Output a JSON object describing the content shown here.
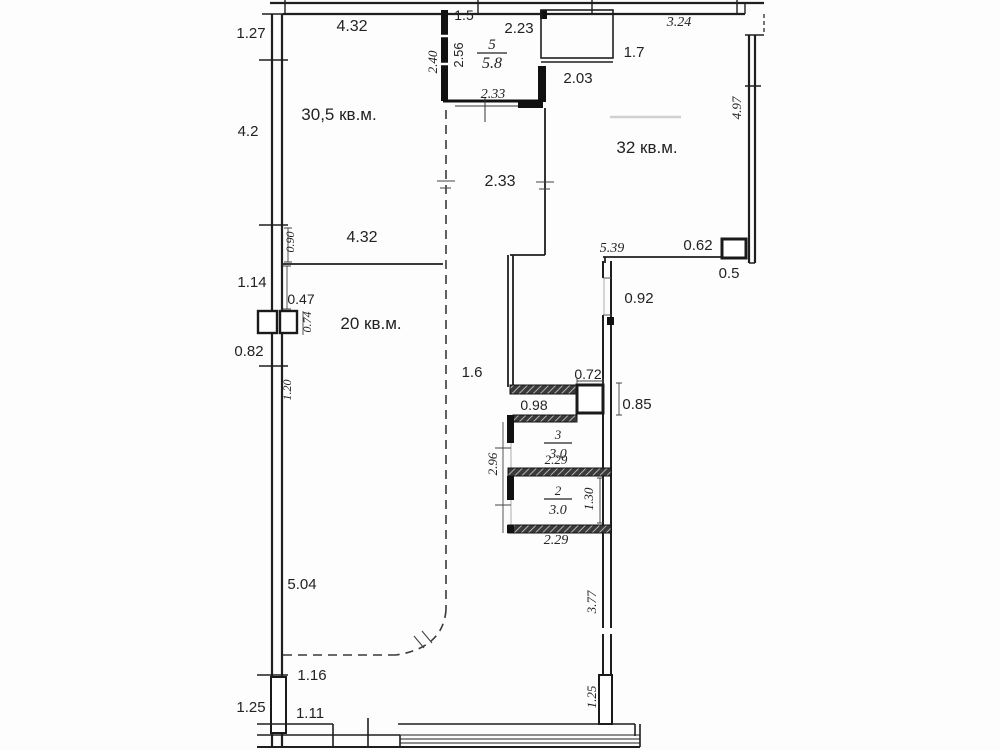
{
  "drawing": {
    "type": "apartment-floor-plan",
    "units": "meters",
    "background_color": "#fdfdfd",
    "wall_color": "#1f1f1f",
    "text_color": "#222222"
  },
  "rooms": [
    {
      "id": "room-living-305",
      "area_label": "30,5 кв.м."
    },
    {
      "id": "room-living-32",
      "area_label": "32 кв.м."
    },
    {
      "id": "room-living-20",
      "area_label": "20 кв.м."
    },
    {
      "id": "room-5",
      "number": "5",
      "area": "5.8"
    },
    {
      "id": "room-3",
      "number": "3",
      "area": "3.0"
    },
    {
      "id": "room-2",
      "number": "2",
      "area": "3.0"
    }
  ],
  "labels": [
    {
      "id": "dim-1-27",
      "text": "1.27",
      "x": 251,
      "y": 38,
      "rot": 0,
      "italic": false,
      "size": 15
    },
    {
      "id": "dim-4-32-top",
      "text": "4.32",
      "x": 352,
      "y": 31,
      "rot": 0,
      "italic": false,
      "size": 16
    },
    {
      "id": "dim-1-5",
      "text": "1.5",
      "x": 464,
      "y": 20,
      "rot": 0,
      "italic": false,
      "size": 14
    },
    {
      "id": "dim-2-23",
      "text": "2.23",
      "x": 519,
      "y": 33,
      "rot": 0,
      "italic": false,
      "size": 15
    },
    {
      "id": "dim-3-24",
      "text": "3.24",
      "x": 679,
      "y": 26,
      "rot": 0,
      "italic": true,
      "size": 14
    },
    {
      "id": "dim-1-7",
      "text": "1.7",
      "x": 634,
      "y": 57,
      "rot": 0,
      "italic": false,
      "size": 15
    },
    {
      "id": "dim-2-03",
      "text": "2.03",
      "x": 578,
      "y": 83,
      "rot": 0,
      "italic": false,
      "size": 15
    },
    {
      "id": "dim-2-33-room5",
      "text": "2.33",
      "x": 493,
      "y": 98,
      "rot": 0,
      "italic": true,
      "size": 14
    },
    {
      "id": "room-area-30-5",
      "text": "30,5 кв.м.",
      "x": 339,
      "y": 120,
      "rot": 0,
      "italic": false,
      "size": 17
    },
    {
      "id": "dim-4-2",
      "text": "4.2",
      "x": 248,
      "y": 136,
      "rot": 0,
      "italic": false,
      "size": 15
    },
    {
      "id": "room-area-32",
      "text": "32 кв.м.",
      "x": 647,
      "y": 153,
      "rot": 0,
      "italic": false,
      "size": 17
    },
    {
      "id": "dim-2-33-mid",
      "text": "2.33",
      "x": 500,
      "y": 186,
      "rot": 0,
      "italic": false,
      "size": 16
    },
    {
      "id": "dim-4-32-mid",
      "text": "4.32",
      "x": 362,
      "y": 242,
      "rot": 0,
      "italic": false,
      "size": 16
    },
    {
      "id": "dim-5-39",
      "text": "5.39",
      "x": 612,
      "y": 252,
      "rot": 0,
      "italic": true,
      "size": 14
    },
    {
      "id": "dim-0-62",
      "text": "0.62",
      "x": 698,
      "y": 250,
      "rot": 0,
      "italic": false,
      "size": 15
    },
    {
      "id": "dim-0-5",
      "text": "0.5",
      "x": 729,
      "y": 278,
      "rot": 0,
      "italic": false,
      "size": 15
    },
    {
      "id": "dim-1-14",
      "text": "1.14",
      "x": 252,
      "y": 287,
      "rot": 0,
      "italic": false,
      "size": 15
    },
    {
      "id": "dim-0-47",
      "text": "0.47",
      "x": 301,
      "y": 304,
      "rot": 0,
      "italic": false,
      "size": 14
    },
    {
      "id": "dim-0-92",
      "text": "0.92",
      "x": 639,
      "y": 303,
      "rot": 0,
      "italic": false,
      "size": 15
    },
    {
      "id": "room-area-20",
      "text": "20 кв.м.",
      "x": 371,
      "y": 329,
      "rot": 0,
      "italic": false,
      "size": 17
    },
    {
      "id": "dim-0-82",
      "text": "0.82",
      "x": 249,
      "y": 356,
      "rot": 0,
      "italic": false,
      "size": 15
    },
    {
      "id": "dim-1-6",
      "text": "1.6",
      "x": 472,
      "y": 377,
      "rot": 0,
      "italic": false,
      "size": 15
    },
    {
      "id": "dim-0-72",
      "text": "0.72",
      "x": 588,
      "y": 379,
      "rot": 0,
      "italic": false,
      "size": 14
    },
    {
      "id": "dim-0-98",
      "text": "0.98",
      "x": 534,
      "y": 410,
      "rot": 0,
      "italic": false,
      "size": 14
    },
    {
      "id": "dim-0-85",
      "text": "0.85",
      "x": 637,
      "y": 409,
      "rot": 0,
      "italic": false,
      "size": 15
    },
    {
      "id": "dim-2-29-room3",
      "text": "2.29",
      "x": 556,
      "y": 464,
      "rot": 0,
      "italic": true,
      "size": 13
    },
    {
      "id": "dim-2-29-room2",
      "text": "2.29",
      "x": 556,
      "y": 544,
      "rot": 0,
      "italic": true,
      "size": 14
    },
    {
      "id": "dim-5-04",
      "text": "5.04",
      "x": 302,
      "y": 589,
      "rot": 0,
      "italic": false,
      "size": 15
    },
    {
      "id": "dim-1-16",
      "text": "1.16",
      "x": 312,
      "y": 680,
      "rot": 0,
      "italic": false,
      "size": 15
    },
    {
      "id": "dim-1-25-left",
      "text": "1.25",
      "x": 251,
      "y": 712,
      "rot": 0,
      "italic": false,
      "size": 15
    },
    {
      "id": "dim-1-11",
      "text": "1.11",
      "x": 310,
      "y": 718,
      "rot": 0,
      "italic": false,
      "size": 15
    },
    {
      "id": "dim-2-40",
      "text": "2.40",
      "x": 437,
      "y": 62,
      "rot": -90,
      "italic": true,
      "size": 13
    },
    {
      "id": "dim-2-56",
      "text": "2.56",
      "x": 463,
      "y": 55,
      "rot": -90,
      "italic": false,
      "size": 13
    },
    {
      "id": "dim-4-97",
      "text": "4.97",
      "x": 741,
      "y": 108,
      "rot": -90,
      "italic": true,
      "size": 13
    },
    {
      "id": "dim-0-90",
      "text": "0.90",
      "x": 294,
      "y": 242,
      "rot": -90,
      "italic": true,
      "size": 12
    },
    {
      "id": "dim-0-74",
      "text": "0.74",
      "x": 311,
      "y": 322,
      "rot": -90,
      "italic": true,
      "size": 12
    },
    {
      "id": "dim-1-20",
      "text": "1.20",
      "x": 291,
      "y": 390,
      "rot": -90,
      "italic": true,
      "size": 12
    },
    {
      "id": "dim-2-96",
      "text": "2.96",
      "x": 497,
      "y": 464,
      "rot": -90,
      "italic": true,
      "size": 13
    },
    {
      "id": "dim-1-30",
      "text": "1.30",
      "x": 593,
      "y": 499,
      "rot": -90,
      "italic": true,
      "size": 13
    },
    {
      "id": "dim-3-77",
      "text": "3.77",
      "x": 596,
      "y": 602,
      "rot": -90,
      "italic": true,
      "size": 13
    },
    {
      "id": "dim-1-25-right",
      "text": "1.25",
      "x": 596,
      "y": 697,
      "rot": -90,
      "italic": true,
      "size": 13
    }
  ],
  "fractions": [
    {
      "id": "room5-tag",
      "num": "5",
      "den": "5.8",
      "x": 492,
      "y": 53,
      "w": 30,
      "size": 15
    },
    {
      "id": "room3-tag",
      "num": "3",
      "den": "3.0",
      "x": 558,
      "y": 443,
      "w": 28,
      "size": 13
    },
    {
      "id": "room2-tag",
      "num": "2",
      "den": "3.0",
      "x": 558,
      "y": 499,
      "w": 28,
      "size": 13
    }
  ]
}
